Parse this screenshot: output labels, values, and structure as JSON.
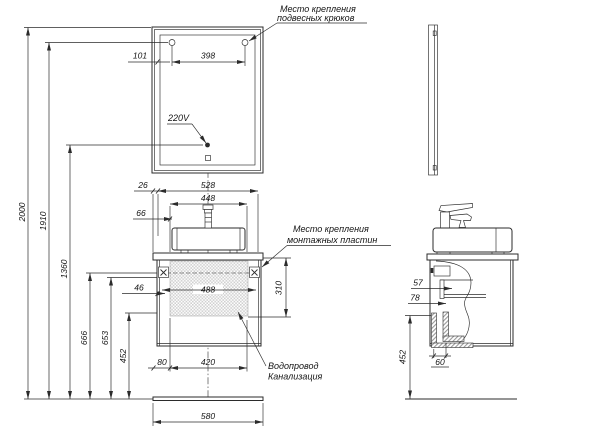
{
  "drawing": {
    "labels": {
      "hooks": {
        "line1": "Место крепления",
        "line2": "подвесных крюков"
      },
      "outlet": "220V",
      "plates": {
        "line1": "Место крепления",
        "line2": "монтажных пластин"
      },
      "plumbing": {
        "line1": "Водопровод",
        "line2": "Канализация"
      }
    },
    "dims": {
      "wall": {
        "total": "2000",
        "hooks": "1910",
        "outlet": "1360",
        "plate_top": "666",
        "plate_axis": "653",
        "supply": "452"
      },
      "mirror": {
        "hook_offset": "101",
        "hook_spacing": "398"
      },
      "top": {
        "edge": "26",
        "span": "528",
        "sink": "448",
        "inset": "66"
      },
      "cabinet": {
        "plate_inset": "46",
        "inner_width": "488",
        "mount_height": "310"
      },
      "bottom": {
        "edge": "80",
        "span": "420",
        "countertop": "580"
      },
      "side": {
        "plate_depth": "57",
        "shelf_depth": "78",
        "front_gap": "60",
        "supply_height": "452"
      }
    },
    "colors": {
      "line": "#2b2b2b",
      "hatch": "#cfcfcf",
      "background": "#ffffff"
    }
  }
}
